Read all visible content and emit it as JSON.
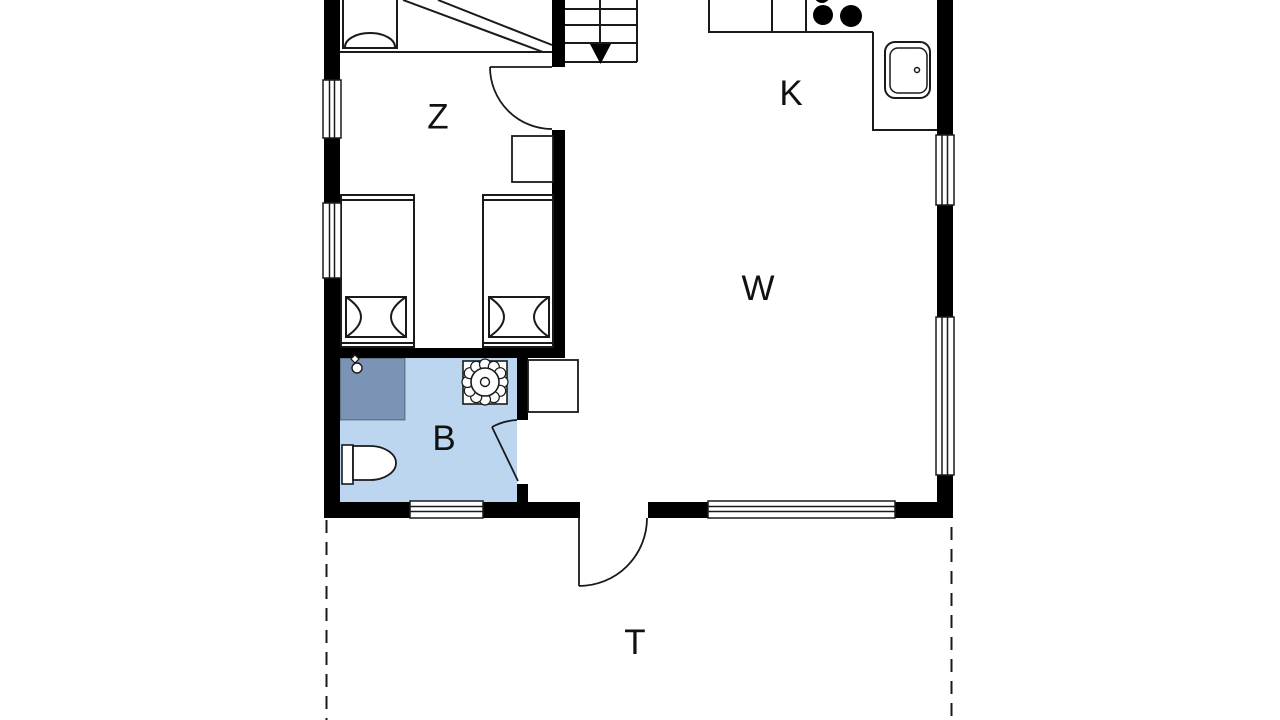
{
  "plan": {
    "rooms": [
      {
        "name": "bedroom",
        "label": "Z"
      },
      {
        "name": "kitchen",
        "label": "K"
      },
      {
        "name": "living-room",
        "label": "W"
      },
      {
        "name": "bathroom",
        "label": "B"
      },
      {
        "name": "terrace",
        "label": "T"
      }
    ],
    "colors": {
      "wall": "#000000",
      "bathroom_floor": "#bcd6f0",
      "shower": "#7b93b4",
      "background": "#ffffff"
    }
  }
}
